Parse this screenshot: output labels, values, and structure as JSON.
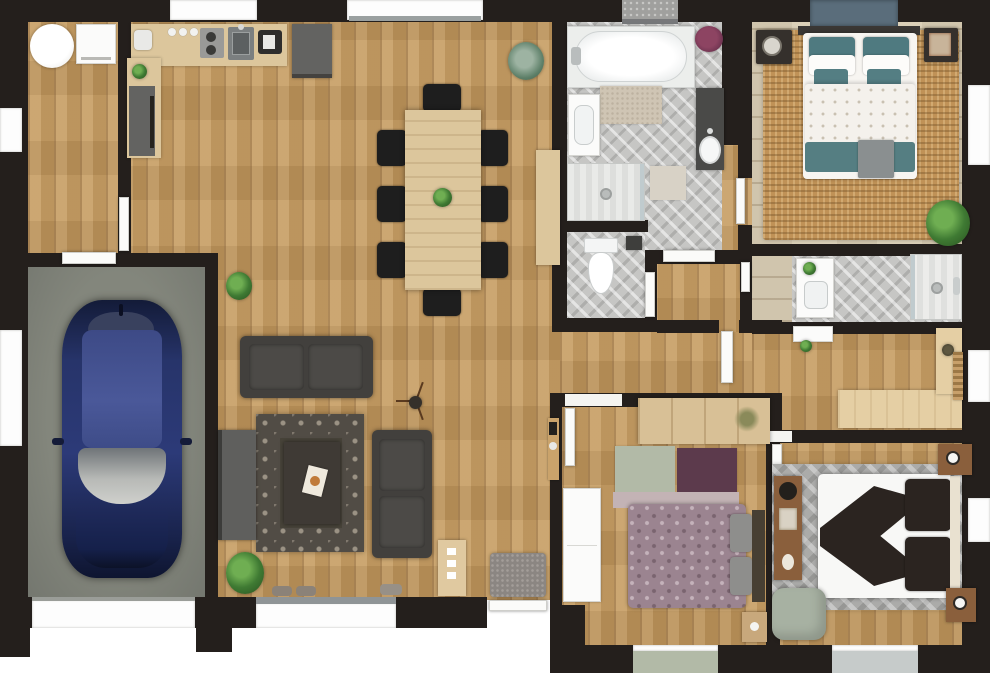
{
  "palette": {
    "background": "#ffffff",
    "wall": "#241f1c",
    "wood_main": "#c49a5f",
    "wood_light": "#d9cdb4",
    "tile": "#c6c6c4",
    "garage_floor": "#74776f",
    "counter_wood": "#dcc69c",
    "cabinet_gray": "#636361",
    "sofa": "#42403d",
    "rug_dark": "#514c45",
    "jute": "#c09257",
    "teal": "#4f7a80",
    "sage": "#b2baa7",
    "plum": "#5c3a4c",
    "mauve": "#c3b3b5",
    "damask": "#9b8490",
    "dark_textile": "#2b2420",
    "chevron_rug": "#ababa9",
    "car_blue": "#1f2a55",
    "door_white": "#fbfbf9",
    "window_slate": "#5a6d7b",
    "wood_red": "#8a5f3c",
    "white_furniture": "#f5f5f3"
  },
  "floor_plan": {
    "type": "residential-floor-plan-3d-top-view",
    "rooms": [
      {
        "name": "garage",
        "items": [
          "blue car",
          "garage door"
        ]
      },
      {
        "name": "laundry-room",
        "items": [
          "washing machine",
          "round table"
        ]
      },
      {
        "name": "kitchen",
        "items": [
          "L-shaped counter",
          "sink",
          "cooktop",
          "coffee maker",
          "fridge"
        ]
      },
      {
        "name": "dining-area",
        "items": [
          "wood table",
          "8 black chairs",
          "sideboard",
          "plant centerpiece"
        ]
      },
      {
        "name": "living-room",
        "items": [
          "two gray sofas",
          "trellis rug",
          "coffee table",
          "tv cabinet",
          "tripod lamp",
          "plants"
        ]
      },
      {
        "name": "family-bathroom",
        "items": [
          "bathtub",
          "walk-in shower",
          "wall sink",
          "dark vanity",
          "bath mats",
          "towel basket"
        ]
      },
      {
        "name": "wc",
        "items": [
          "toilet",
          "paper box"
        ]
      },
      {
        "name": "master-bedroom",
        "items": [
          "double bed teal bedding",
          "jute rug",
          "two nightstands",
          "plant",
          "slate window panel"
        ]
      },
      {
        "name": "ensuite-shower-room",
        "items": [
          "white vanity",
          "walk-in shower"
        ]
      },
      {
        "name": "office",
        "items": [
          "L-shaped desk",
          "white dresser",
          "radiator",
          "desk plant"
        ]
      },
      {
        "name": "bedroom-2",
        "items": [
          "damask bed",
          "wardrobe",
          "patch rug sage-plum-mauve",
          "white cabinet",
          "nightstand"
        ]
      },
      {
        "name": "bedroom-3",
        "items": [
          "white bed with dark throw",
          "chevron rug",
          "two nightstands",
          "console",
          "sage pouf"
        ]
      },
      {
        "name": "entry",
        "items": [
          "front door",
          "gray doormat",
          "console table",
          "key shelf"
        ]
      }
    ]
  }
}
